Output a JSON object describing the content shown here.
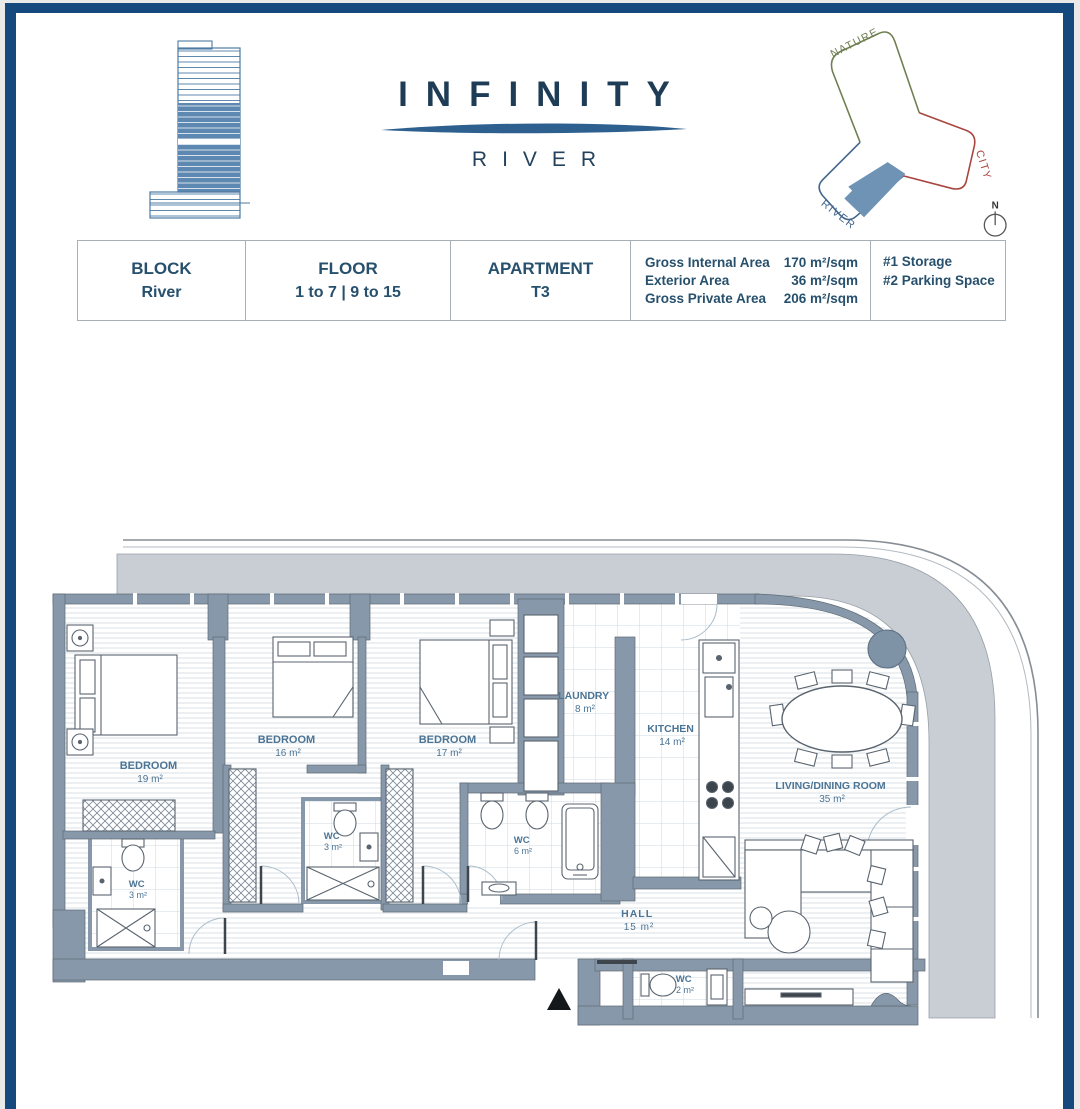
{
  "page": {
    "frame_color": "#15497d",
    "background": "#ffffff"
  },
  "header": {
    "logo": {
      "icon": "tower-logo"
    },
    "brand": {
      "title": "INFINITY",
      "subtitle": "RIVER",
      "color": "#1e3c55",
      "wave_color": "#2d608f"
    },
    "orientation": {
      "arms": [
        {
          "label": "NATURE",
          "color": "#6f7f52"
        },
        {
          "label": "CITY",
          "color": "#a8453e"
        },
        {
          "label": "RIVER",
          "color": "#41658c"
        }
      ],
      "unit_fill": "#6e93b5",
      "compass": {
        "label": "N"
      }
    }
  },
  "info_table": {
    "cells": [
      {
        "label": "BLOCK",
        "value": "River"
      },
      {
        "label": "FLOOR",
        "value": "1 to 7 | 9 to 15"
      },
      {
        "label": "APARTMENT",
        "value": "T3"
      }
    ],
    "areas": [
      {
        "label": "Gross Internal Area",
        "value": "170 m²/sqm"
      },
      {
        "label": "Exterior Area",
        "value": "36 m²/sqm"
      },
      {
        "label": "Gross Private Area",
        "value": "206 m²/sqm"
      }
    ],
    "extras": [
      {
        "label": "#1 Storage"
      },
      {
        "label": "#2 Parking Space"
      }
    ]
  },
  "floor_plan": {
    "rooms": [
      {
        "name": "BEDROOM",
        "area": "19 m²"
      },
      {
        "name": "BEDROOM",
        "area": "16 m²"
      },
      {
        "name": "BEDROOM",
        "area": "17 m²"
      },
      {
        "name": "LAUNDRY",
        "area": "8 m²"
      },
      {
        "name": "KITCHEN",
        "area": "14 m²"
      },
      {
        "name": "LIVING/DINING ROOM",
        "area": "35 m²"
      },
      {
        "name": "WC",
        "area": "3 m²"
      },
      {
        "name": "WC",
        "area": "3 m²"
      },
      {
        "name": "WC",
        "area": "6 m²"
      },
      {
        "name": "WC",
        "area": "2 m²"
      },
      {
        "name": "HALL",
        "area": "15 m²"
      }
    ],
    "entry_marker": "entry-arrow",
    "colors": {
      "wall": "#8798aa",
      "terrace": "#c9ced4",
      "label": "#4b7495",
      "column": "#7e93a6"
    }
  }
}
